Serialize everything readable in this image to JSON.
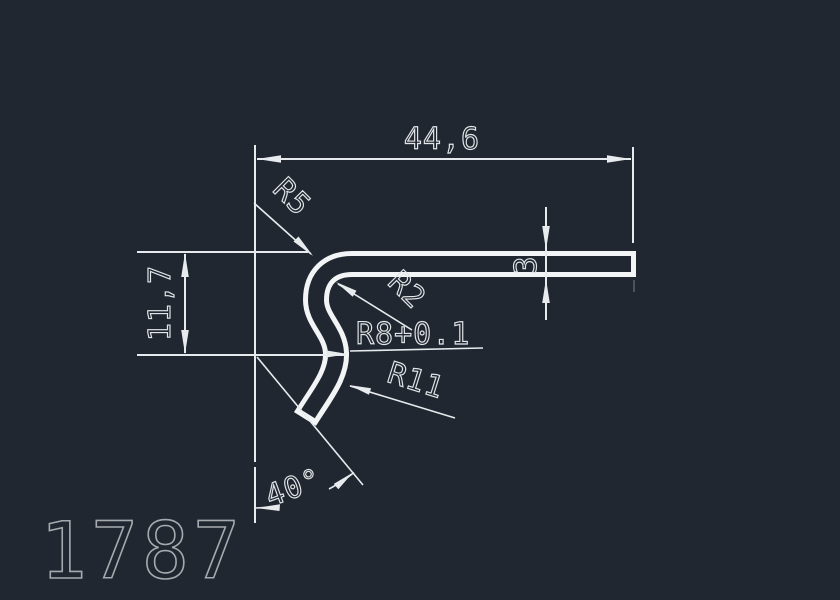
{
  "drawing": {
    "number": "1787",
    "labels": {
      "width": "44,6",
      "height": "11,7",
      "thickness": "3",
      "fillet_top": "R5",
      "fillet_inner": "R2",
      "radius_middle": "R8+0.1",
      "radius_lower": "R11",
      "end_angle": "40°"
    },
    "colors": {
      "background": "#212730",
      "dimension_lines": "#e8ebee",
      "profile_outline": "#f2f4f5",
      "drawing_number": "#a6aaae"
    }
  }
}
